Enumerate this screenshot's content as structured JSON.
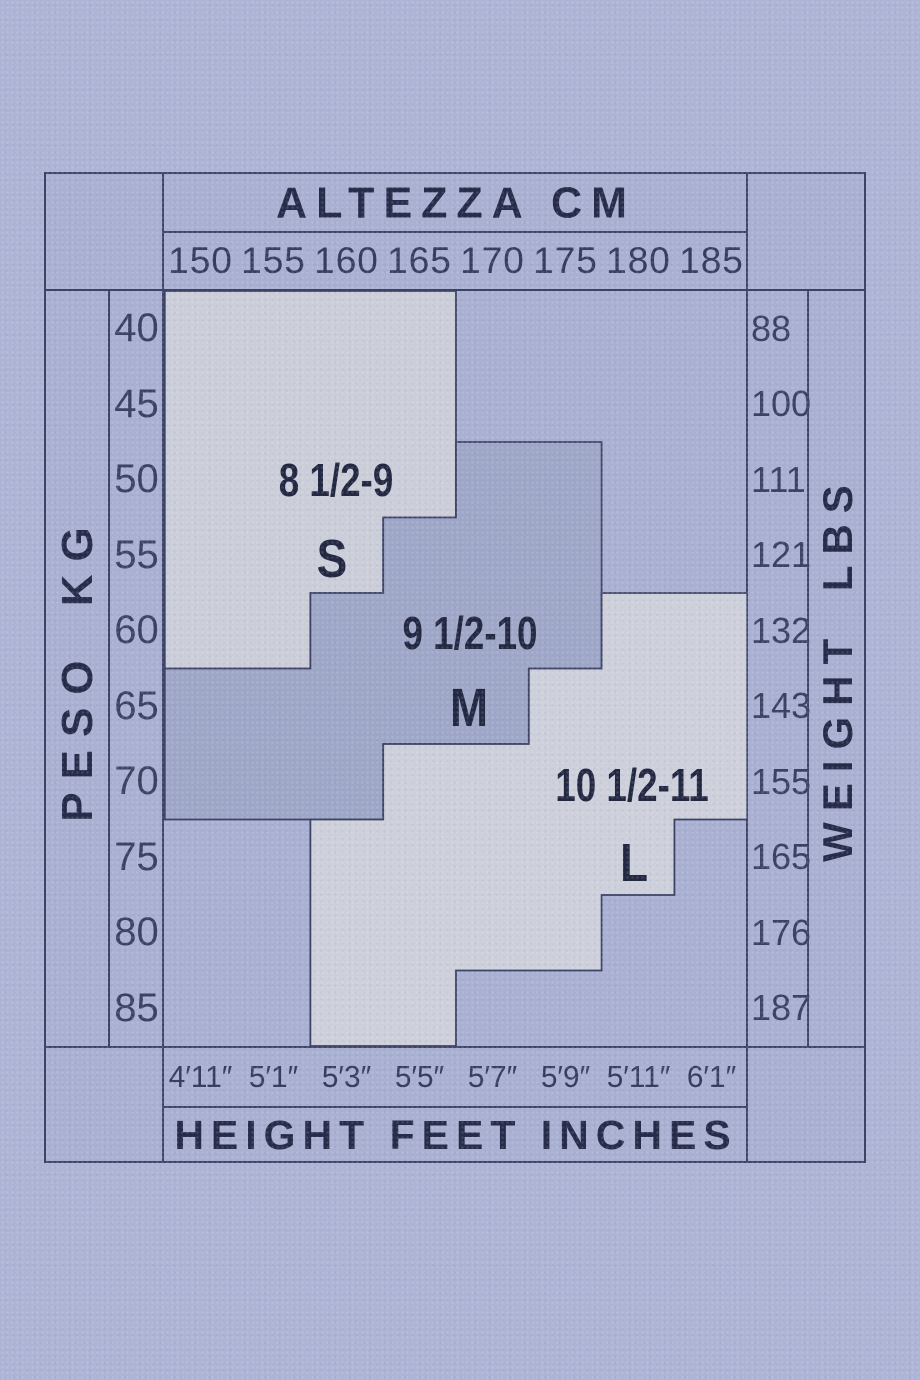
{
  "page": {
    "background": "#adb4d5"
  },
  "table": {
    "line_color": "#3d4366",
    "top": {
      "title": "ALTEZZA CM",
      "ticks": [
        "150",
        "155",
        "160",
        "165",
        "170",
        "175",
        "180",
        "185"
      ]
    },
    "bottom": {
      "title": "HEIGHT FEET INCHES",
      "ticks": [
        "4′11″",
        "5′1″",
        "5′3″",
        "5′5″",
        "5′7″",
        "5′9″",
        "5′11″",
        "6′1″"
      ]
    },
    "left": {
      "label": "PESO KG",
      "values": [
        "40",
        "45",
        "50",
        "55",
        "60",
        "65",
        "70",
        "75",
        "80",
        "85"
      ]
    },
    "right": {
      "label": "WEIGHT LBS",
      "values": [
        "88",
        "100",
        "111",
        "121",
        "132",
        "143",
        "155",
        "165",
        "176",
        "187"
      ]
    },
    "regions": {
      "s": {
        "range": "8 1/2-9",
        "size": "S",
        "fill": "#cbced9"
      },
      "m": {
        "range": "9 1/2-10",
        "size": "M",
        "fill": "#9fa7c8"
      },
      "l": {
        "range": "10 1/2-11",
        "size": "L",
        "fill": "#cdd0db"
      }
    }
  },
  "chart_data": {
    "type": "heatmap",
    "title": "Hosiery size chart: height vs weight",
    "x": {
      "top_label": "ALTEZZA CM",
      "bottom_label": "HEIGHT FEET INCHES",
      "cm": [
        150,
        155,
        160,
        165,
        170,
        175,
        180,
        185
      ],
      "feet_inches": [
        "4′11″",
        "5′1″",
        "5′3″",
        "5′5″",
        "5′7″",
        "5′9″",
        "5′11″",
        "6′1″"
      ]
    },
    "y": {
      "left_label": "PESO KG",
      "right_label": "WEIGHT LBS",
      "kg": [
        40,
        45,
        50,
        55,
        60,
        65,
        70,
        75,
        80,
        85
      ],
      "lbs": [
        88,
        100,
        111,
        121,
        132,
        143,
        155,
        165,
        176,
        187
      ]
    },
    "sizes": [
      {
        "size": "S",
        "range": "8 1/2-9",
        "cells_by_kg": {
          "40": [
            150,
            155,
            160,
            165
          ],
          "45": [
            150,
            155,
            160,
            165
          ],
          "50": [
            150,
            155,
            160,
            165
          ],
          "55": [
            150,
            155,
            160
          ],
          "60": [
            150,
            155
          ]
        }
      },
      {
        "size": "M",
        "range": "9 1/2-10",
        "cells_by_kg": {
          "50": [
            170,
            175
          ],
          "55": [
            165,
            170,
            175
          ],
          "60": [
            160,
            165,
            170,
            175
          ],
          "65": [
            150,
            155,
            160,
            165,
            170
          ],
          "70": [
            150,
            155,
            160
          ]
        }
      },
      {
        "size": "L",
        "range": "10 1/2-11",
        "cells_by_kg": {
          "60": [
            180,
            185
          ],
          "65": [
            175,
            180,
            185
          ],
          "70": [
            165,
            170,
            175,
            180,
            185
          ],
          "75": [
            160,
            165,
            170,
            175,
            180
          ],
          "80": [
            160,
            165,
            170,
            175
          ],
          "85": [
            160,
            165
          ]
        }
      }
    ],
    "legend_position": "in-region labels",
    "grid": "region outlines only"
  }
}
